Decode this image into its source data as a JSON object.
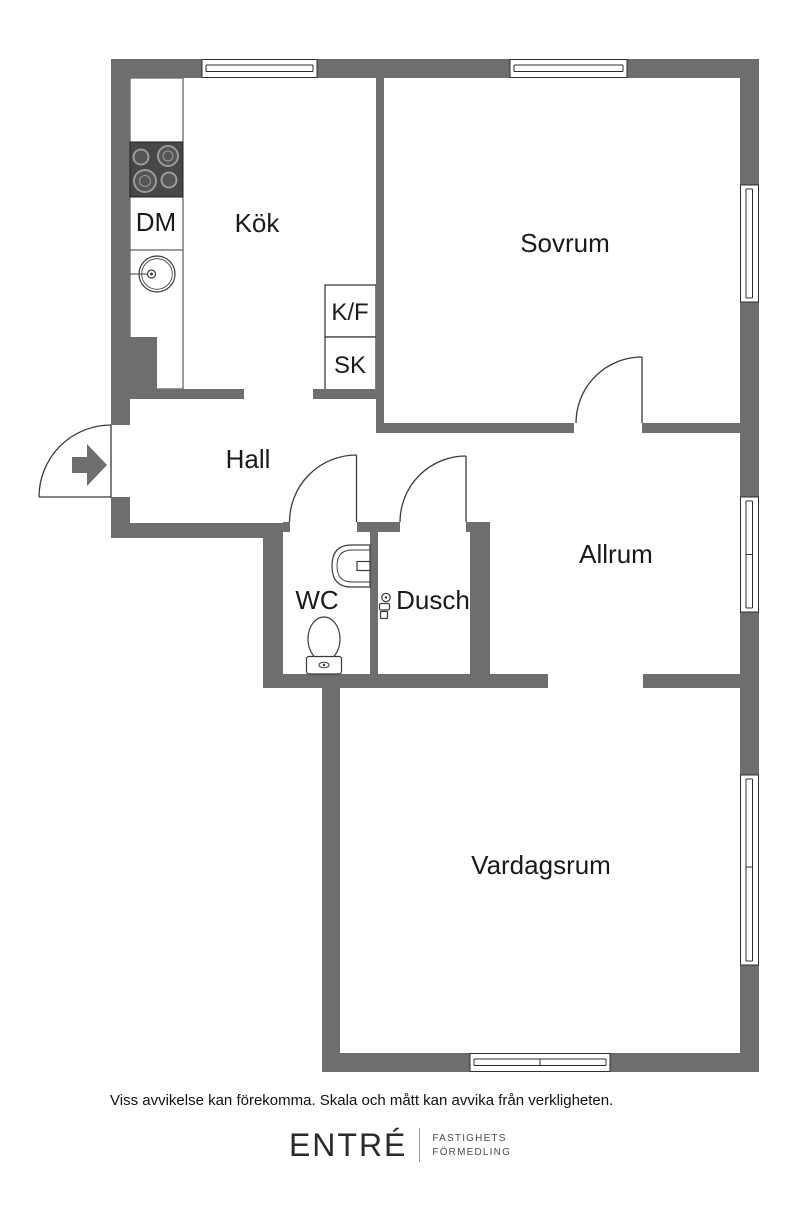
{
  "plan": {
    "rooms": {
      "kok": {
        "label": "Kök"
      },
      "sovrum": {
        "label": "Sovrum"
      },
      "hall": {
        "label": "Hall"
      },
      "wc": {
        "label": "WC"
      },
      "dusch": {
        "label": "Dusch"
      },
      "allrum": {
        "label": "Allrum"
      },
      "vardagsrum": {
        "label": "Vardagsrum"
      }
    },
    "fixtures": {
      "dishwasher": {
        "label": "DM"
      },
      "fridge_freezer": {
        "label": "K/F"
      },
      "closet": {
        "label": "SK"
      }
    },
    "icons": [
      "entry-arrow-icon",
      "stove-icon",
      "sink-icon",
      "washbasin-icon",
      "toilet-icon",
      "shower-mixer-icon",
      "window-glyph",
      "door-swing-arc"
    ]
  },
  "footer": {
    "disclaimer": "Viss avvikelse kan förekomma. Skala och mått kan avvika från verkligheten.",
    "brand_name": "ENTRÉ",
    "brand_line1": "FASTIGHETS",
    "brand_line2": "FÖRMEDLING"
  },
  "colors": {
    "wall": "#6e6e6e",
    "stove": "#474747",
    "line": "#3a3a3a",
    "text": "#1a1a1a"
  }
}
